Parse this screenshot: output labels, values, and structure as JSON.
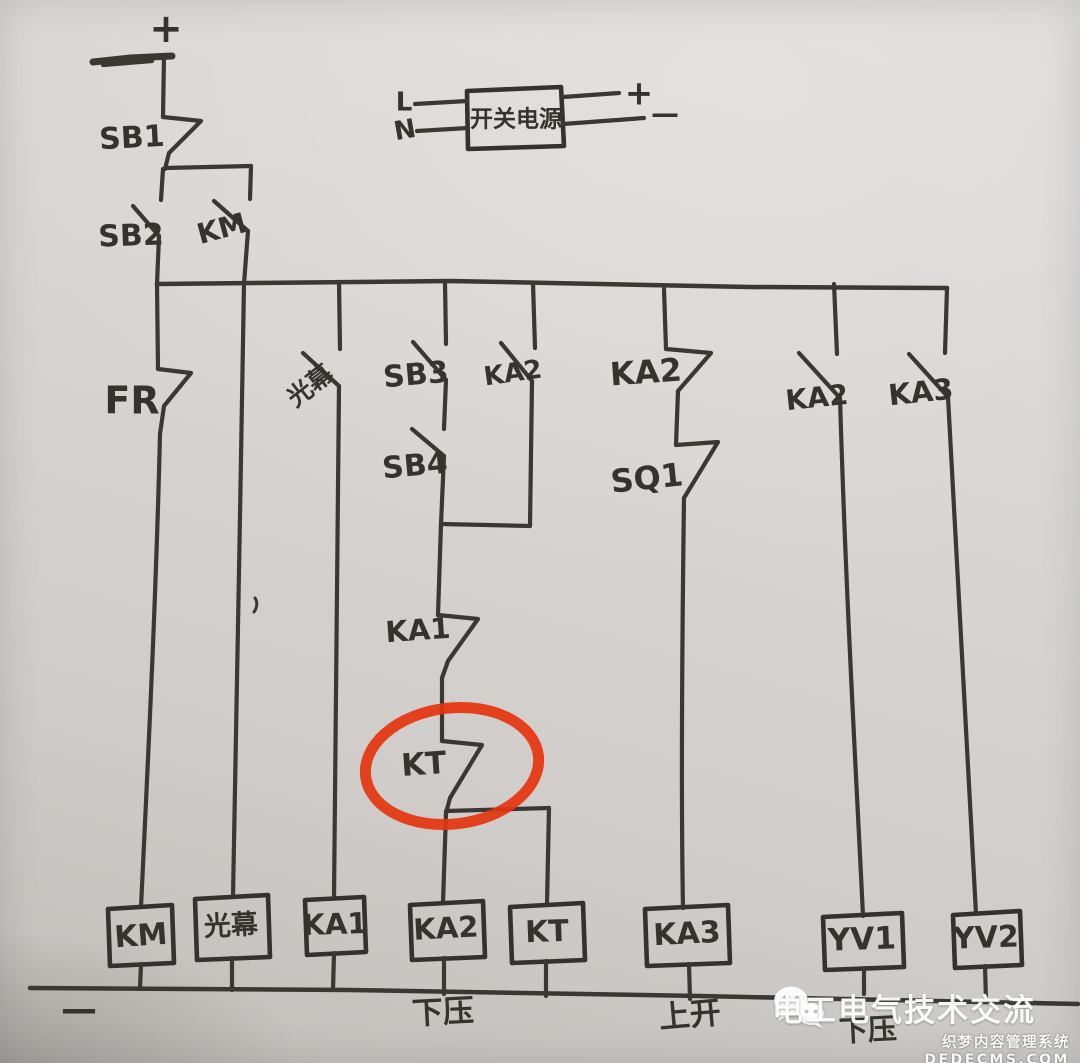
{
  "rails": {
    "top_plus_label": "+",
    "bottom_minus_label": "—"
  },
  "power_supply": {
    "label": "开关电源",
    "line_label": "L",
    "neutral_label": "N",
    "plus_label": "+",
    "minus_label": "—"
  },
  "contacts": {
    "sb1": "SB1",
    "sb2": "SB2",
    "km": "KM",
    "fr": "FR",
    "light_curtain": "光幕",
    "sb3": "SB3",
    "sb4": "SB4",
    "ka2_seal": "KA2",
    "ka1": "KA1",
    "kt": "KT",
    "ka2_nc": "KA2",
    "sq1": "SQ1",
    "ka2_no": "KA2",
    "ka3_no": "KA3"
  },
  "coils": [
    "KM",
    "光幕",
    "KA1",
    "KA2",
    "KT",
    "KA3",
    "YV1",
    "YV2"
  ],
  "captions": {
    "down_press": "下压",
    "up_open": "上开",
    "down_press_2": "下压"
  },
  "highlight": {
    "color": "#e5340f"
  },
  "watermark": {
    "brand": "电工电气技术交流",
    "cms_name": "织梦内容管理系统",
    "cms_domain": "DEDECMS.COM"
  }
}
